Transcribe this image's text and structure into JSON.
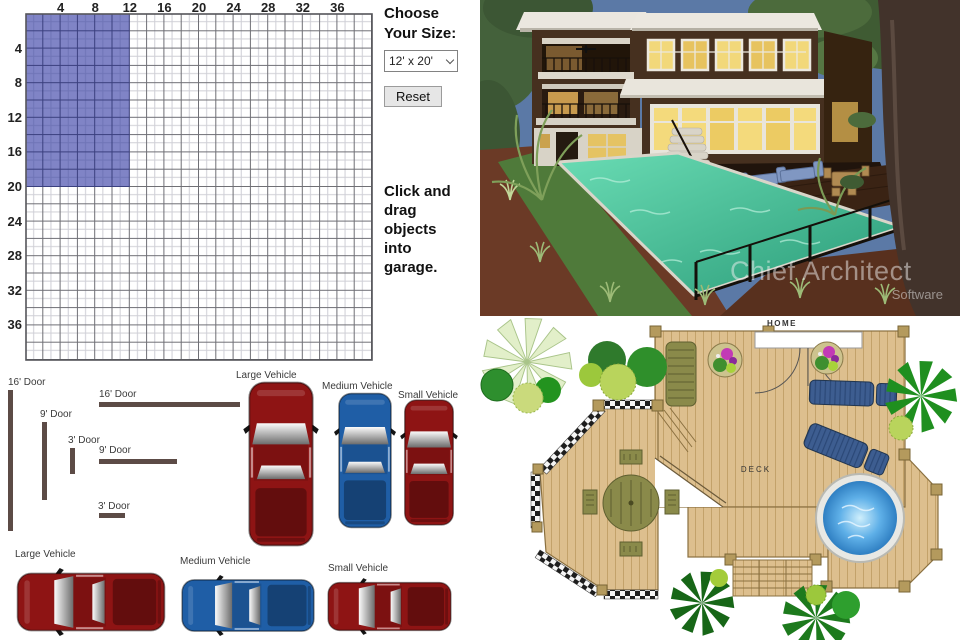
{
  "garage_planner": {
    "size_heading": "Choose Your Size:",
    "size_select_value": "12' x 20'",
    "reset_label": "Reset",
    "instruction": "Click and drag objects into garage.",
    "grid": {
      "column_labels": [
        "4",
        "8",
        "12",
        "16",
        "20",
        "24",
        "28",
        "32",
        "36"
      ],
      "row_labels": [
        "4",
        "8",
        "12",
        "16",
        "20",
        "24",
        "28",
        "32",
        "36"
      ],
      "max_feet": 40,
      "selected_size": {
        "width_ft": 12,
        "depth_ft": 20
      },
      "highlight_color": "#8084c6",
      "door_color": "#5c4b46"
    },
    "doors": [
      {
        "label": "16' Door",
        "orientation": "vertical"
      },
      {
        "label": "9' Door",
        "orientation": "vertical"
      },
      {
        "label": "3' Door",
        "orientation": "vertical"
      },
      {
        "label": "16' Door",
        "orientation": "horizontal"
      },
      {
        "label": "9' Door",
        "orientation": "horizontal"
      },
      {
        "label": "3' Door",
        "orientation": "horizontal"
      }
    ],
    "vehicles": [
      {
        "label": "Large Vehicle",
        "orientation": "vertical",
        "color": "#8e1414"
      },
      {
        "label": "Medium Vehicle",
        "orientation": "vertical",
        "color": "#1f5ea6"
      },
      {
        "label": "Small Vehicle",
        "orientation": "vertical",
        "color": "#8e1414"
      },
      {
        "label": "Large Vehicle",
        "orientation": "horizontal",
        "color": "#8e1414"
      },
      {
        "label": "Medium Vehicle",
        "orientation": "horizontal",
        "color": "#1f5ea6"
      },
      {
        "label": "Small Vehicle",
        "orientation": "horizontal",
        "color": "#8e1414"
      }
    ]
  },
  "render_3d": {
    "watermark_title": "Chief Architect",
    "watermark_subtitle": "Software"
  },
  "deck_plan": {
    "home_label": "HOME",
    "deck_label": "DECK"
  }
}
